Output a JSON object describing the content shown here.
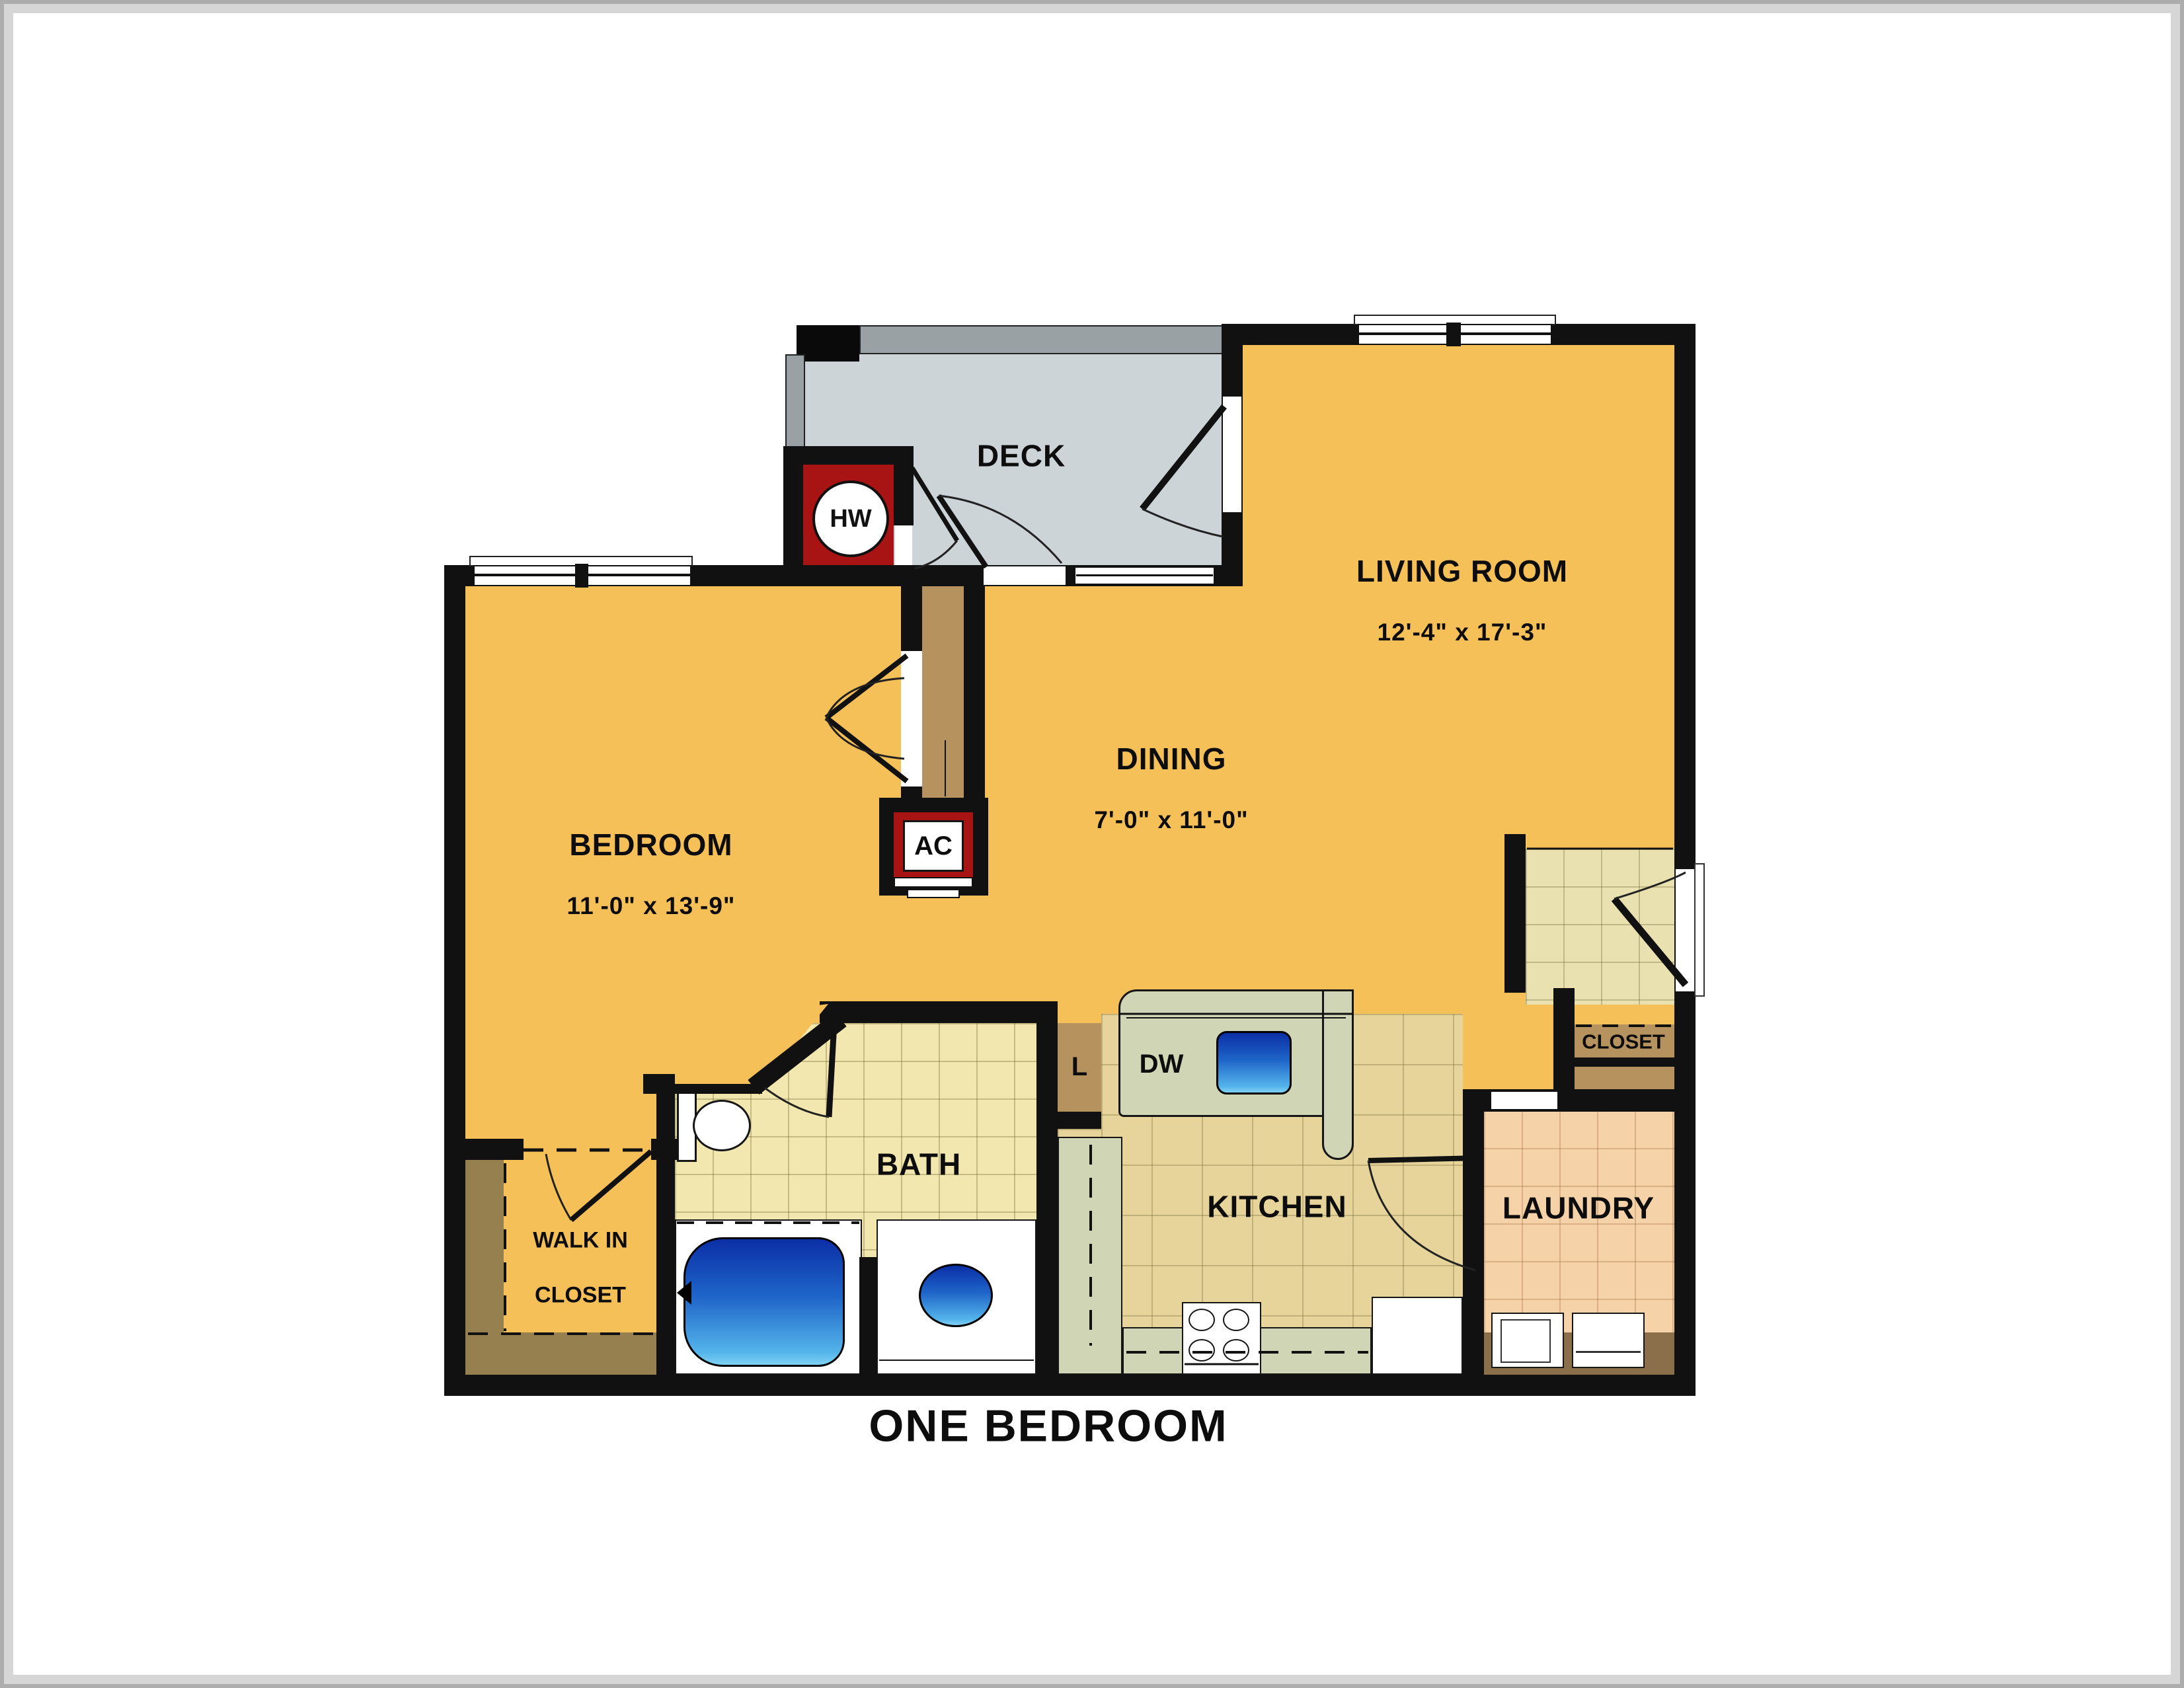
{
  "title": "ONE BEDROOM",
  "rooms": {
    "living_room": {
      "name": "LIVING ROOM",
      "dims": "12'-4\" x 17'-3\""
    },
    "dining": {
      "name": "DINING",
      "dims": "7'-0\" x 11'-0\""
    },
    "bedroom": {
      "name": "BEDROOM",
      "dims": "11'-0\" x 13'-9\""
    },
    "deck": {
      "name": "DECK"
    },
    "bath": {
      "name": "BATH"
    },
    "kitchen": {
      "name": "KITCHEN"
    },
    "laundry": {
      "name": "LAUNDRY"
    },
    "walk_in_closet": {
      "line1": "WALK IN",
      "line2": "CLOSET"
    },
    "entry_closet": {
      "name": "CLOSET"
    }
  },
  "fixtures": {
    "hot_water_heater": "HW",
    "air_conditioner": "AC",
    "dishwasher": "DW",
    "linen_closet": "L"
  },
  "colors": {
    "floor-orange": "#f6c058",
    "deck-gray": "#ccd4d8",
    "railing-gray": "#9aa1a5",
    "utility-red": "#a81414",
    "bath-tile": "#f2e7ae",
    "kitchen-tile": "#e6d49b",
    "entry-tile": "#e9e2b0",
    "laundry-tile": "#f6d2a8",
    "closet-tan": "#b6925f",
    "shelf-brown": "#97804f",
    "laundry-counter-brown": "#8a6f4a",
    "counter-sage": "#d0d5b5",
    "wall-black": "#111111"
  }
}
